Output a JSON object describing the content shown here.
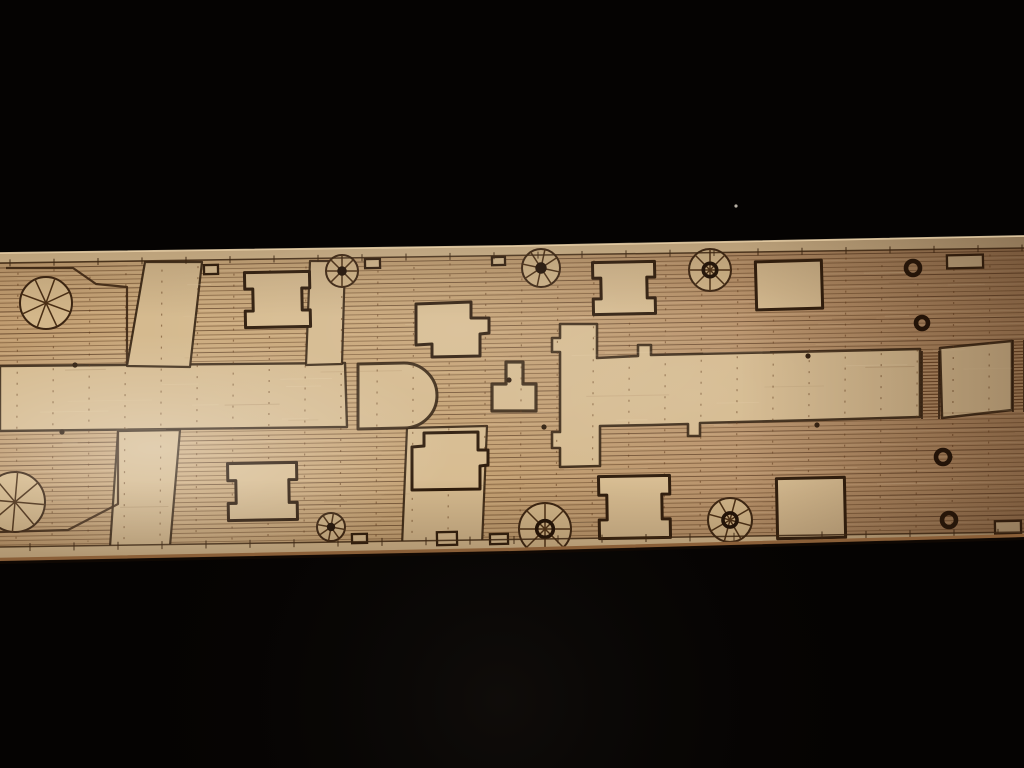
{
  "description": "Close-up photograph of a light wooden model-ship deck sheet, laser-etched with plank seams, hatch coamings, winch wheels, mooring rings and margin lines, lying diagonally across a black background",
  "colors": {
    "background": "#050302",
    "bg_glow": "rgba(32,27,22,0.38)",
    "speck": "#d8d0c2",
    "wood_stops": [
      [
        "0",
        "#c09c70"
      ],
      [
        "0.18",
        "#ccab7e"
      ],
      [
        "0.45",
        "#c5a274"
      ],
      [
        "0.72",
        "#b9936b"
      ],
      [
        "1",
        "#a9825c"
      ]
    ],
    "smooth": "#d5ba8f",
    "hatch_fill": "#d7bc91",
    "etch": "#2e1c0c",
    "etch_soft": "#3b2512",
    "plank_dark": "rgba(86,54,26,0.5)",
    "plank_darker": "rgba(70,42,20,0.65)",
    "plank_light": "rgba(240,216,178,0.16)",
    "butt_dots": "rgba(96,58,28,0.55)",
    "grain_light": "#f0dcb4",
    "grain_dark": "#7a5634",
    "rung": "#6a4526",
    "wheel_fill": "#d3b78a",
    "spoke": "#4a2f15",
    "ring": "#1f1106",
    "margin_line": "#3a2410",
    "edge_top_highlight": "rgba(236,212,170,0.85)",
    "edge_side": "#8a5f38",
    "edge_shadow": "rgba(18,9,3,0.85)",
    "hotspot": "#ffffff",
    "right_shade_rgb": "50,28,13",
    "v_shade_rgb": "60,38,20"
  },
  "wood": {
    "outline": "M0,253 L512,246 L1024,236 L1024,537 L512,551 L0,561 Z",
    "top_edge": "M0,253 L512,246 L1024,236",
    "bottom_edge": "M0,561 L512,551 L1024,537",
    "plank": {
      "y_start": 246,
      "y_end": 566,
      "spacing": 4.4,
      "tilt": -17
    },
    "butt_step": 36,
    "margin_top": {
      "y0": 263,
      "y1": 248
    },
    "margin_bottom": {
      "y0": 547,
      "y1": 532
    },
    "tick_step": 44
  },
  "smooth_regions": [
    {
      "name": "midship-band-left",
      "d": "M0,366 L345,363 L347,427 L0,431 Z",
      "sw": 2.4
    },
    {
      "name": "fore-alley-top",
      "d": "M145,262 L202,262 L190,367 L127,366 Z",
      "sw": 2.2
    },
    {
      "name": "fore-alley-bottom",
      "d": "M118,431 L180,430 L170,546 L110,547 Z",
      "sw": 2.2
    },
    {
      "name": "hatch-alley-top",
      "d": "M310,261 L345,261 L342,364 L306,365 Z",
      "sw": 2.2
    },
    {
      "name": "hatch-alley-bottom",
      "d": "M407,428 L487,426 L482,545 L402,546 Z",
      "sw": 2.2
    },
    {
      "name": "deckhouse-and-band-right",
      "d": "M560,324 L597,324 L597,358 L638,356 L638,345 L651,345 L651,355 L920,349 L920,417 L817,420 L700,423 L700,436 L688,436 L688,424 L652,425 L600,426 L600,466 L560,467 L560,448 L552,448 L552,432 L560,432 L560,352 L552,352 L552,338 L560,338 Z",
      "sw": 2.6
    },
    {
      "name": "aft-house-rect",
      "d": "M940,348 L1012,341 L1012,410 L942,418 Z",
      "sw": 2.6
    },
    {
      "name": "d-shaped-structure",
      "d": "M358,364 L404,363 A33,32.5 0 0 1 404,428 L358,429 Z",
      "sw": 3
    },
    {
      "name": "t-shaped-fitting",
      "d": "M506,362 L523,362 L523,384 L536,384 L536,411 L492,411 L492,384 L506,384 Z",
      "sw": 3.2
    },
    {
      "name": "top-margin-strip",
      "d": "M0,253 L1024,236 L1024,248 L0,263 Z",
      "sw": 0
    },
    {
      "name": "bottom-margin-strip",
      "d": "M0,547 L1024,532 L1024,537 L512,551 L0,561 Z",
      "sw": 0
    }
  ],
  "outlined_blocks": [
    {
      "name": "forecastle-block-outline",
      "d": "M6,268 L73,268 L96,284 L127,287 L127,364"
    },
    {
      "name": "quarter-block-outline",
      "d": "M118,431 L118,504 L68,530 L0,532"
    }
  ],
  "hatches": [
    {
      "name": "hatch-coaming",
      "type": "sideNotch",
      "x": 245,
      "y": 272,
      "w": 65,
      "h": 55,
      "rot": -1.2
    },
    {
      "name": "hatch-coaming",
      "type": "sideNotch",
      "x": 593,
      "y": 262,
      "w": 62,
      "h": 52,
      "rot": -1.2
    },
    {
      "name": "hatch-coaming",
      "type": "sideNotch",
      "x": 228,
      "y": 463,
      "w": 69,
      "h": 57,
      "rot": -1
    },
    {
      "name": "hatch-coaming",
      "type": "sideNotch",
      "x": 599,
      "y": 476,
      "w": 71,
      "h": 62,
      "rot": -1
    },
    {
      "name": "hatch-coaming",
      "type": "plain",
      "x": 756,
      "y": 261,
      "w": 66,
      "h": 48,
      "rot": -1.6
    },
    {
      "name": "hatch-coaming",
      "type": "plain",
      "x": 777,
      "y": 478,
      "w": 68,
      "h": 60,
      "rot": -1.2
    },
    {
      "name": "stepped-hatch",
      "type": "path",
      "d": "M416,304 L471,302 L471,318 L489,318 L489,333 L480,334 L480,356 L432,357 L432,344 L416,345 Z"
    },
    {
      "name": "stepped-hatch",
      "type": "path",
      "d": "M412,447 L424,446 L424,433 L478,432 L478,450 L488,450 L488,465 L480,466 L480,489 L412,490 Z"
    }
  ],
  "wheels": [
    {
      "cx": 46,
      "cy": 303,
      "r": 26,
      "center": "none",
      "rot": 20
    },
    {
      "cx": 15,
      "cy": 502,
      "r": 30,
      "center": "none",
      "rot": 5
    },
    {
      "cx": 342,
      "cy": 271,
      "r": 16,
      "center": "dot",
      "rot": 0
    },
    {
      "cx": 541,
      "cy": 268,
      "r": 19,
      "center": "dot",
      "rot": 12
    },
    {
      "cx": 710,
      "cy": 270,
      "r": 21,
      "center": "ring",
      "rot": 0
    },
    {
      "cx": 331,
      "cy": 527,
      "r": 14,
      "center": "dot",
      "rot": 10
    },
    {
      "cx": 545,
      "cy": 529,
      "r": 26,
      "center": "ring",
      "rot": 0
    },
    {
      "cx": 730,
      "cy": 520,
      "r": 22,
      "center": "ring",
      "rot": 15
    }
  ],
  "rings": [
    [
      913,
      268,
      7
    ],
    [
      922,
      323,
      6
    ],
    [
      943,
      457,
      7
    ],
    [
      949,
      520,
      7
    ]
  ],
  "dots": [
    [
      75,
      365
    ],
    [
      62,
      432
    ],
    [
      509,
      380
    ],
    [
      544,
      427
    ],
    [
      808,
      356
    ],
    [
      817,
      425
    ]
  ],
  "small_rects": [
    [
      204,
      265,
      14,
      9
    ],
    [
      365,
      259,
      15,
      9
    ],
    [
      492,
      257,
      13,
      8
    ],
    [
      947,
      255,
      36,
      13
    ],
    [
      352,
      534,
      15,
      9
    ],
    [
      437,
      532,
      20,
      13
    ],
    [
      490,
      534,
      18,
      10
    ],
    [
      995,
      521,
      26,
      13
    ]
  ],
  "ladders": [
    [
      922,
      351,
      17,
      68
    ],
    [
      1013,
      340,
      11,
      72
    ]
  ],
  "speck": {
    "x": 736,
    "y": 206,
    "r": 1.6
  },
  "hotspots": [
    {
      "cx": 155,
      "cy": 448,
      "r": 300,
      "sy": 0.38,
      "op": 0.3
    },
    {
      "cx": 460,
      "cy": 330,
      "r": 320,
      "sy": 0.5,
      "op": 0.1
    },
    {
      "cx": 690,
      "cy": 395,
      "r": 260,
      "sy": 0.45,
      "op": 0.07
    }
  ]
}
